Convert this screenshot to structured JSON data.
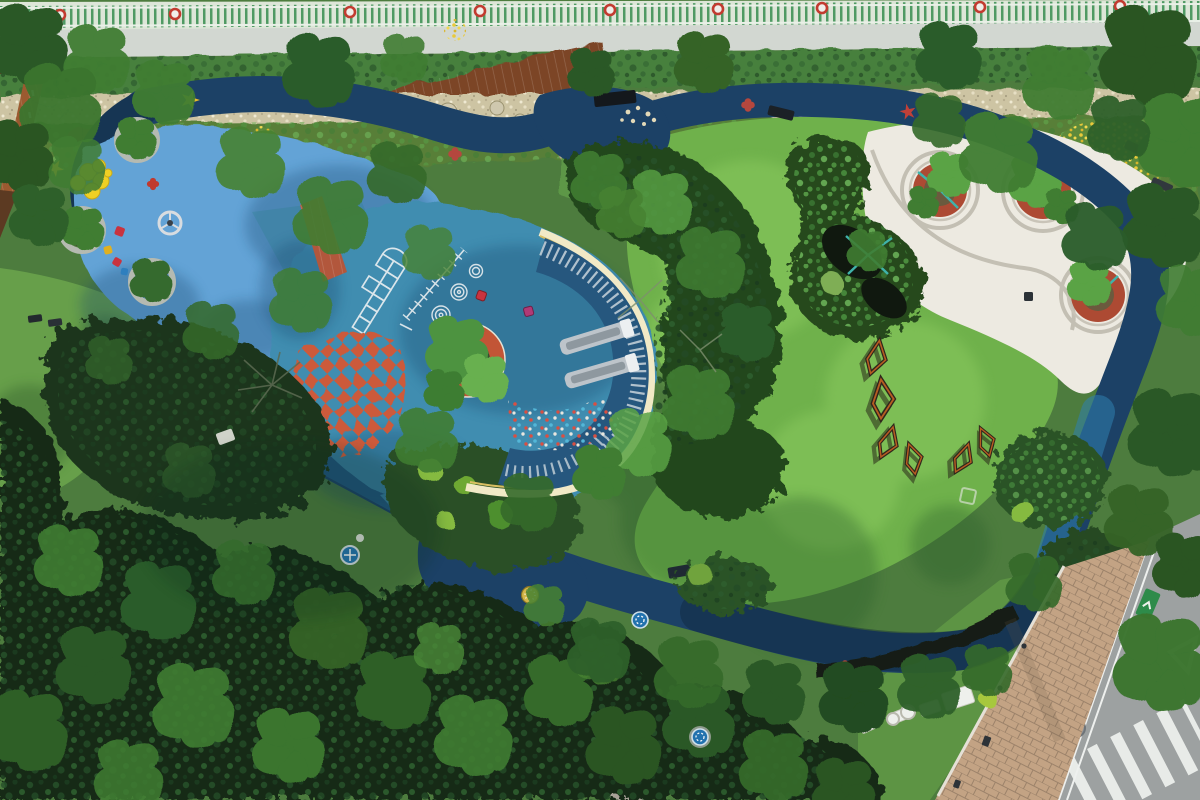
{
  "scene": {
    "title": "Aerial view of a community park",
    "description": "Top-down drone photograph of a landscaped pocket park: a dark blue looping running track encircles a light-blue splash playground with yellow lily-pad discs and stars, a teal play plaza with hopscotch and checkerboard markings, a circular tree planter with an orange ring, a crescent slide mound edged by a cream band with twin metal slides, a bright lawn with corten-steel zigzag benches, and a white paved plaza with three brick-ringed tree planters; dense tree canopy fills the lower edge and a city street with a zebra crosswalk sits at bottom right."
  },
  "palette": {
    "fenceBg": "#dde6d8",
    "fenceGreen": "#4f9a63",
    "roadTop": "#d2d7d1",
    "hedge": "#47803d",
    "gravel": "#cdc4a3",
    "bedGreen": "#587f39",
    "bedSoil": "#7b5a38",
    "flowerYellow": "#e9c93a",
    "trackNavy": "#1c4166",
    "trackTeal": "#2a6f9e",
    "trackHi": "#2f7fae",
    "trackShadow": "#0e2238",
    "padBlue": "#64a3d6",
    "padTeal": "#3f8db0",
    "padShade": "#16456b",
    "moundNavy": "#26577e",
    "slat": "#c9d4da",
    "cream": "#f1e9c6",
    "creamEdge": "#d9bf62",
    "checker": "#cc5a3a",
    "ringOrange": "#c25536",
    "soil": "#4a4438",
    "plaza": "#edeae1",
    "plazaLine": "#b6b1a4",
    "brickRing": "#ad4a33",
    "tealBranch": "#3fb3ab",
    "lawn": "#6fb14b",
    "lawnLight": "#92d063",
    "lawnShadow": "#2c5e2a",
    "shrubDark": "#1c351f",
    "shrubMid": "#2c5226",
    "treeDark": "#2c5c2a",
    "treeMid": "#3f7d33",
    "treeLight": "#5aa344",
    "canopy": "#142b19",
    "corten": "#b65c22",
    "cortenDark": "#2f261c",
    "slide": "#bdc4ca",
    "slideChannel": "#8e989f",
    "brickPath": "#b2573c",
    "boardwalk": "#9b5a30",
    "stone": "#a8a298",
    "sidewalk": "#c3a384",
    "road": "#9da1a1",
    "white": "#eef0ec",
    "starYellow": "#e7bb2e",
    "starRed": "#c04038",
    "bush": "#85ba3f",
    "mulch": "#10180f"
  },
  "features": {
    "track_decals": [
      "yellow-star",
      "red-star",
      "red-clover x3",
      "yellow-medallion",
      "blue-medallion x3",
      "white-medallion"
    ],
    "playground_markings": [
      "hopscotch 1-9",
      "measuring line with ticks",
      "three concentric ring targets",
      "orange checkerboard"
    ],
    "equipment": [
      "twin metal slides on crescent mound",
      "steering wheel toy",
      "spring riders",
      "yellow lily-pad discs"
    ],
    "site_furniture": [
      "park benches",
      "picnic table",
      "corten zigzag benches x6",
      "white garden walls",
      "litter bins"
    ],
    "street_elements": [
      "zebra crosswalk",
      "yield triangle",
      "bike lane marker",
      "manhole cover",
      "brick sidewalk",
      "perimeter fence with signs"
    ]
  }
}
